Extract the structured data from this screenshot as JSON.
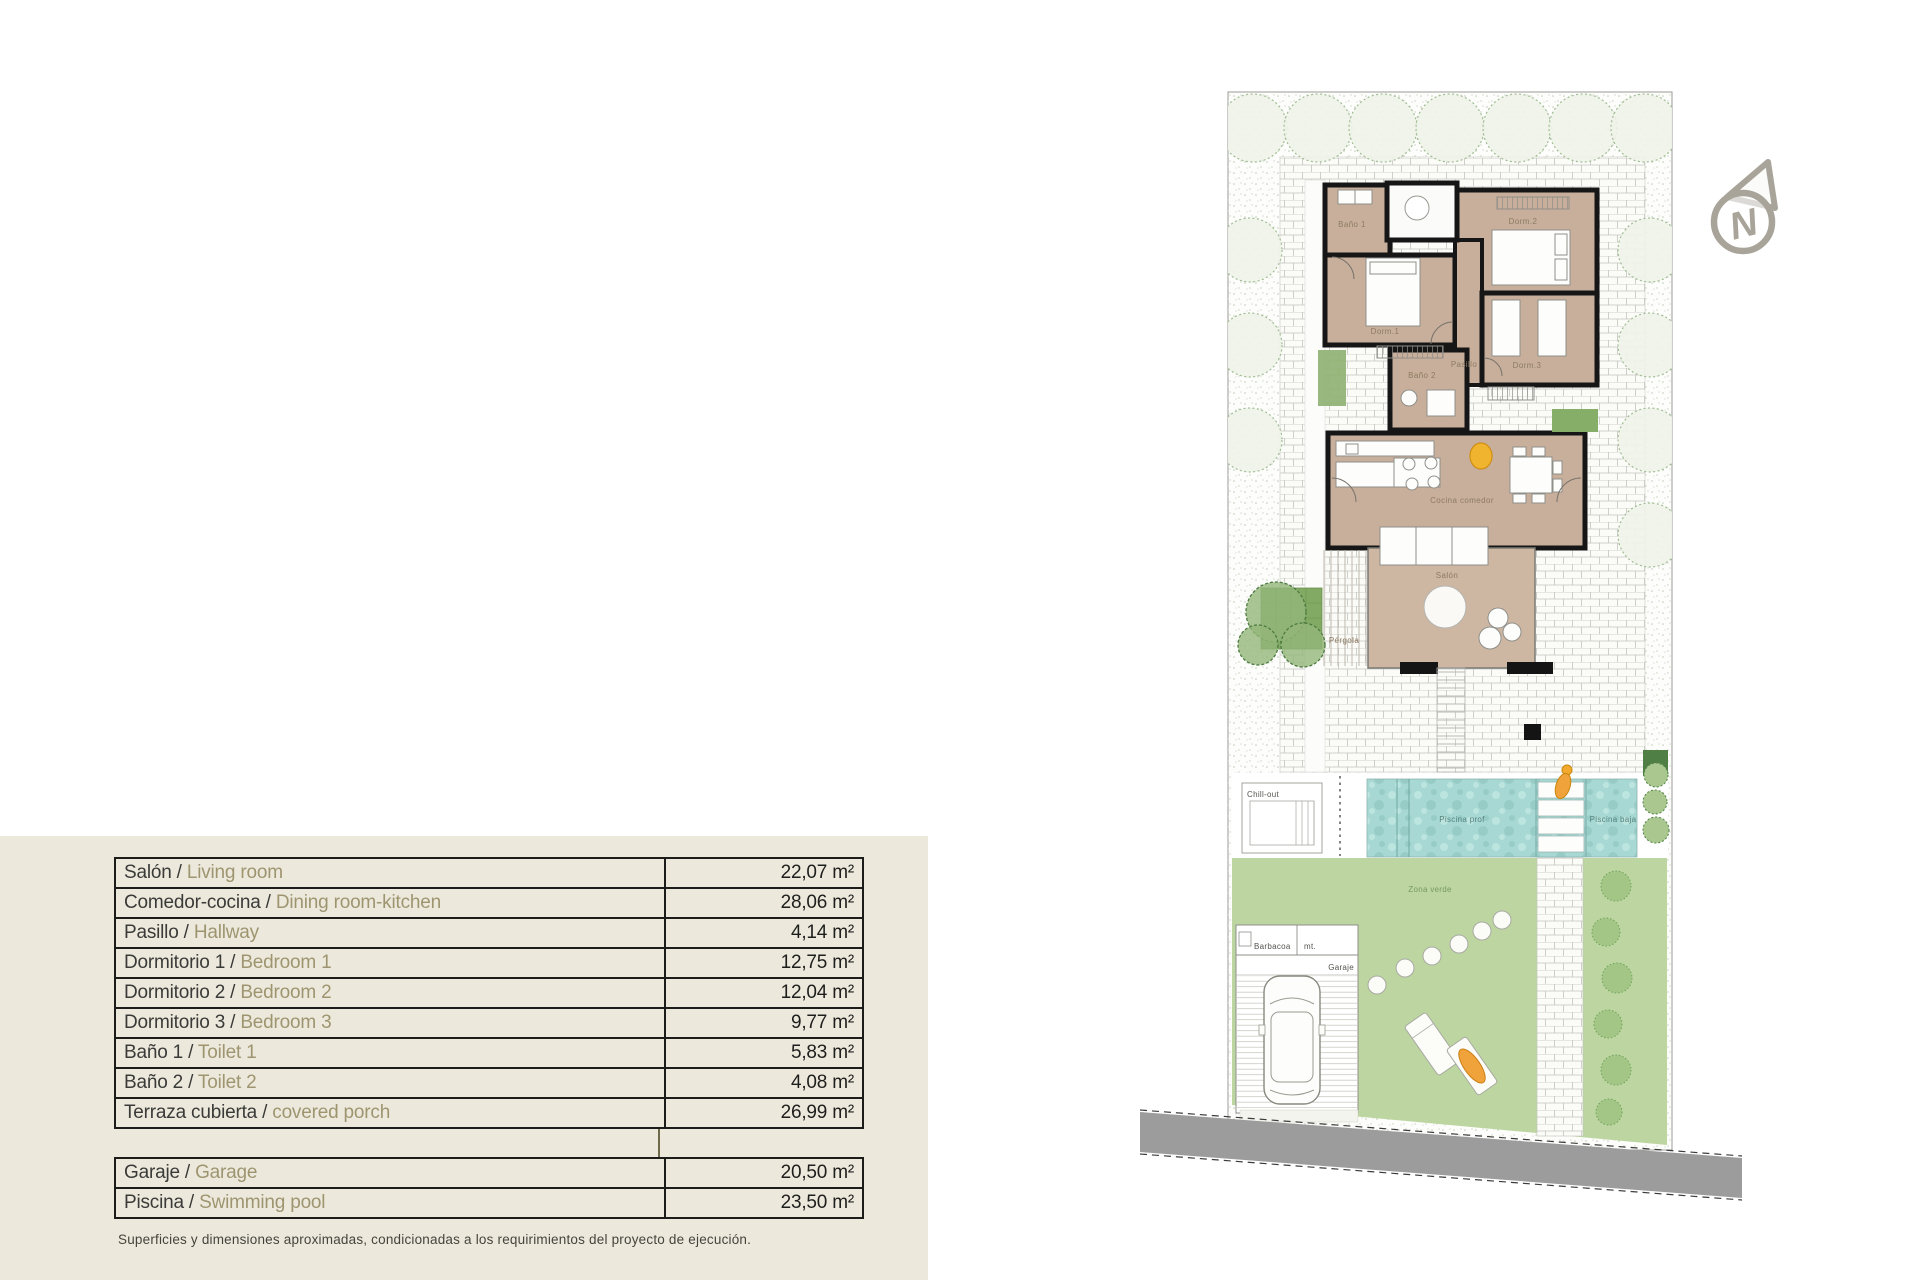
{
  "panel": {
    "background": "#ece9dc"
  },
  "table": {
    "rows": [
      {
        "es": "Salón /",
        "en": "Living room",
        "area": "22,07 m²"
      },
      {
        "es": "Comedor-cocina /",
        "en": "Dining room-kitchen",
        "area": "28,06 m²"
      },
      {
        "es": "Pasillo /",
        "en": "Hallway",
        "area": "4,14 m²"
      },
      {
        "es": "Dormitorio 1 /",
        "en": "Bedroom 1",
        "area": "12,75 m²"
      },
      {
        "es": "Dormitorio 2 /",
        "en": "Bedroom 2",
        "area": "12,04 m²"
      },
      {
        "es": "Dormitorio 3 /",
        "en": "Bedroom 3",
        "area": "9,77 m²"
      },
      {
        "es": "Baño 1 /",
        "en": "Toilet 1",
        "area": "5,83 m²"
      },
      {
        "es": "Baño 2 /",
        "en": "Toilet 2",
        "area": "4,08 m²"
      },
      {
        "es": "Terraza cubierta /",
        "en": "covered porch",
        "area": "26,99 m²"
      }
    ],
    "extra_rows": [
      {
        "es": "Garaje /",
        "en": "Garage",
        "area": "20,50 m²"
      },
      {
        "es": "Piscina /",
        "en": "Swimming pool",
        "area": "23,50 m²"
      }
    ],
    "footnote": "Superficies y dimensiones aproximadas, condicionadas a los requirimientos del proyecto de ejecución."
  },
  "plan": {
    "compass_letter": "N",
    "room_labels": {
      "bano1": "Baño 1",
      "dorm2": "Dorm.2",
      "dorm1": "Dorm.1",
      "bano2": "Baño 2",
      "pasillo": "Pasillo",
      "dorm3": "Dorm.3",
      "cocina_comedor": "Cocina comedor",
      "salon": "Salón",
      "pergola": "Pérgola"
    },
    "site_labels": {
      "chill_out": "Chill-out",
      "piscina_prof": "Piscina prof",
      "piscina_baja": "Piscina baja",
      "zona_verde": "Zona verde",
      "barbacoa": "Barbacoa",
      "mt": "mt.",
      "garaje": "Garaje"
    },
    "colors": {
      "wall": "#161616",
      "room_fill": "#c8af9b",
      "lawn": "#bdd6a1",
      "water_base": "#a7d8d3",
      "road": "#9c9c9c",
      "hedge_dark": "#4f7f45",
      "accent_orange": "#f0a33a",
      "compass_gray": "#a8a49a"
    }
  }
}
